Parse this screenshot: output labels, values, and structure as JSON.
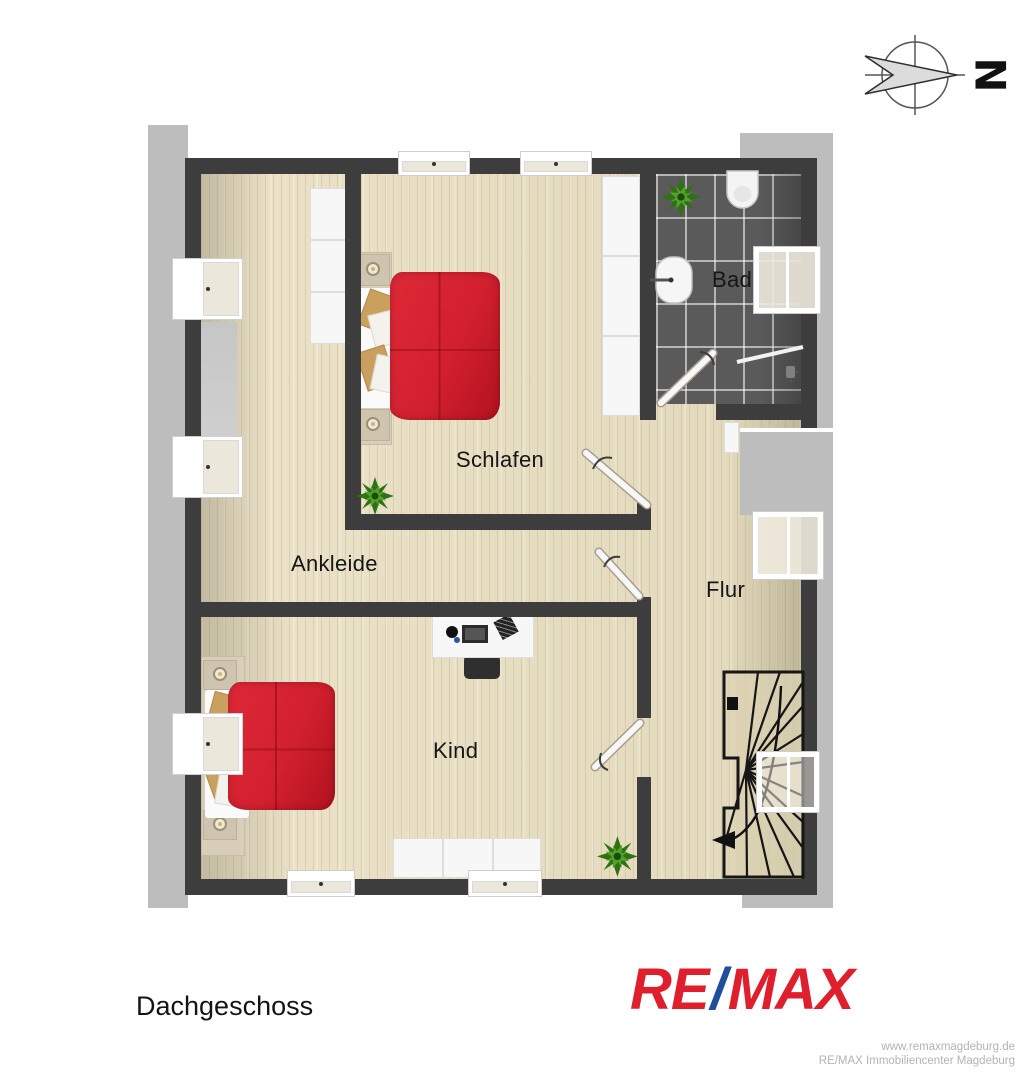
{
  "plan": {
    "floor_title": "Dachgeschoss",
    "compass": {
      "direction_label": "N"
    },
    "rooms": {
      "schlafen": {
        "label": "Schlafen"
      },
      "ankleide": {
        "label": "Ankleide"
      },
      "bad": {
        "label": "Bad"
      },
      "flur": {
        "label": "Flur"
      },
      "kind": {
        "label": "Kind"
      }
    }
  },
  "branding": {
    "logo": {
      "re": "RE",
      "slash": "/",
      "max": "MAX"
    },
    "website": "www.remaxmagdeburg.de",
    "office": "RE/MAX Immobiliencenter Magdeburg"
  },
  "colors": {
    "wall": "#3d3d3d",
    "eaves_gray": "#bdbdbd",
    "floor_wood": "#e8dfc6",
    "bath_tile": "#5a5a5a",
    "bed_red": "#d2202e",
    "plant_green": "#2f7212",
    "logo_red": "#e01f2d",
    "logo_blue": "#1e4e9c",
    "footnote_gray": "#b3b3b3"
  }
}
